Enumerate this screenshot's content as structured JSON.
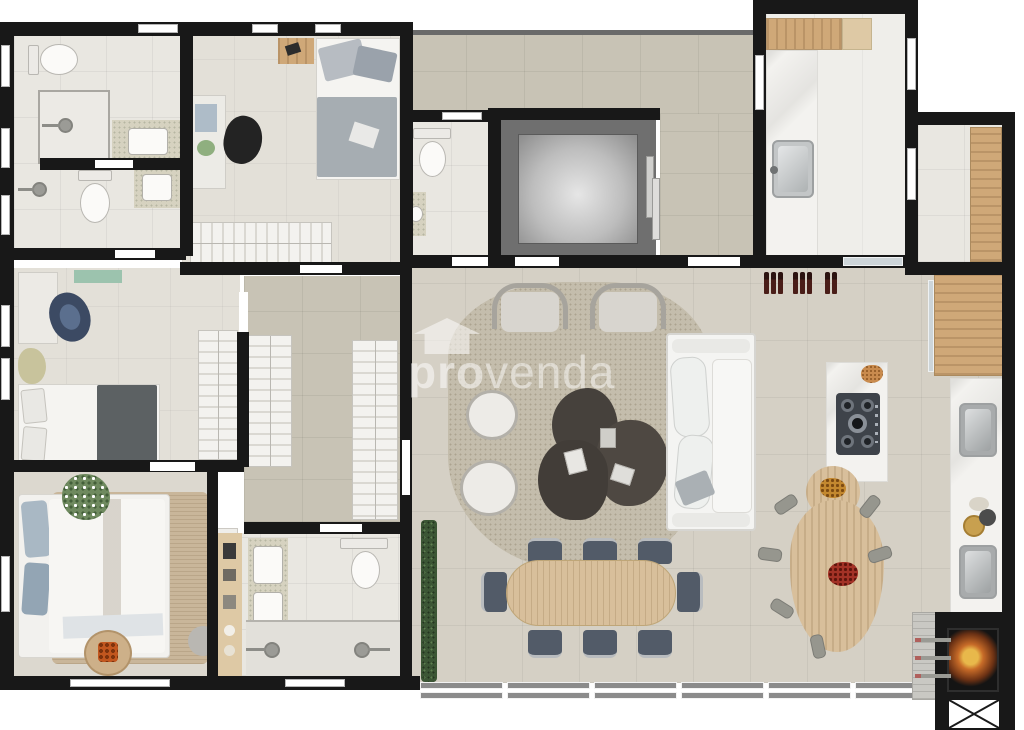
{
  "watermark": {
    "brand_bold": "pro",
    "brand_light": "venda",
    "icon": "house-logo-icon"
  },
  "palette": {
    "wall": "#181818",
    "floor_living": "#d5d0c5",
    "floor_corridor": "#c8c3b5",
    "floor_bath": "#e9e7e1",
    "floor_bedroom": "#e3e0d8",
    "floor_master": "#dcd8cf",
    "floor_service": "#efeeea",
    "rug_living": "#c4bdac",
    "rug_jute": "#c9b69a",
    "wood": "#cfa878",
    "wood_light": "#dec9a5",
    "wood_table": "#d8bf9b",
    "sofa": "#f4f4f2",
    "dark_table": "#46413c",
    "elevator": "#6f6f6f",
    "hedge": "#3c5635",
    "fire": "#d8822f",
    "wine": "#4a1d18",
    "chair_dining": "#525b68",
    "stool": "#96968e",
    "granite": "#d6d2c0",
    "glass": "#cdd5d9",
    "watermark": "rgba(255,255,255,0.52)"
  }
}
